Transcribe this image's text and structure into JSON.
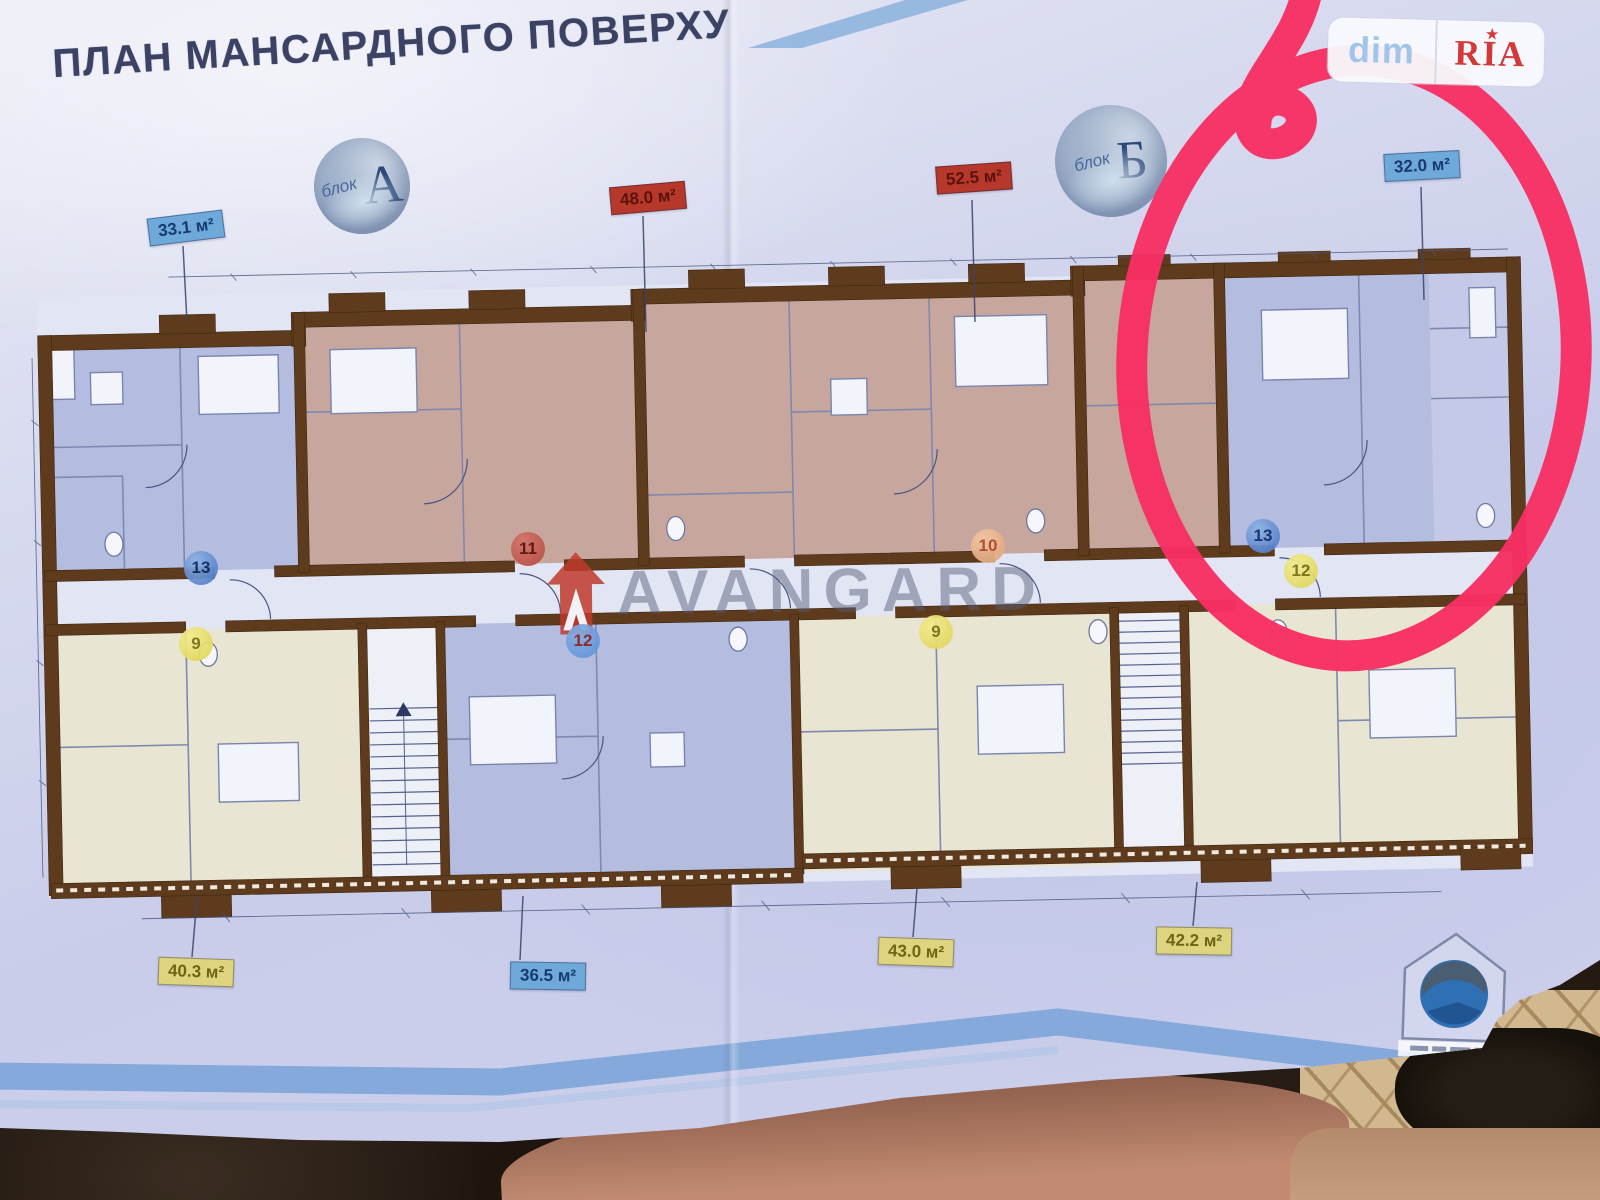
{
  "page": {
    "title": "ПЛАН МАНСАРДНОГО ПОВЕРХУ",
    "blocks": [
      {
        "small": "блок",
        "letter": "А"
      },
      {
        "small": "блок",
        "letter": "Б"
      }
    ],
    "flags": [
      {
        "text": "33.1 м²",
        "style": "blue"
      },
      {
        "text": "48.0 м²",
        "style": "red"
      },
      {
        "text": "52.5 м²",
        "style": "red"
      },
      {
        "text": "32.0 м²",
        "style": "blue"
      },
      {
        "text": "40.3 м²",
        "style": "yellow"
      },
      {
        "text": "36.5 м²",
        "style": "blue"
      },
      {
        "text": "43.0 м²",
        "style": "yellow"
      },
      {
        "text": "42.2 м²",
        "style": "yellow"
      }
    ],
    "units": [
      {
        "number": "13"
      },
      {
        "number": "11"
      },
      {
        "number": "12"
      },
      {
        "number": "9"
      },
      {
        "number": "10"
      },
      {
        "number": "9"
      },
      {
        "number": "13"
      },
      {
        "number": "12"
      }
    ],
    "watermark": {
      "text": "AVANGARD"
    },
    "overlay_logo": {
      "left": "dim",
      "right": "RIA"
    }
  },
  "colors": {
    "marker_red": "#f82f63",
    "flag_blue": "#6ea9da",
    "flag_red": "#b5382a",
    "flag_yellow": "#ded37e",
    "wall_brown": "#5f3b1e",
    "room_blue": "#b4bce0",
    "room_mauve": "#c7a69e",
    "room_cream": "#e9e5d3"
  }
}
